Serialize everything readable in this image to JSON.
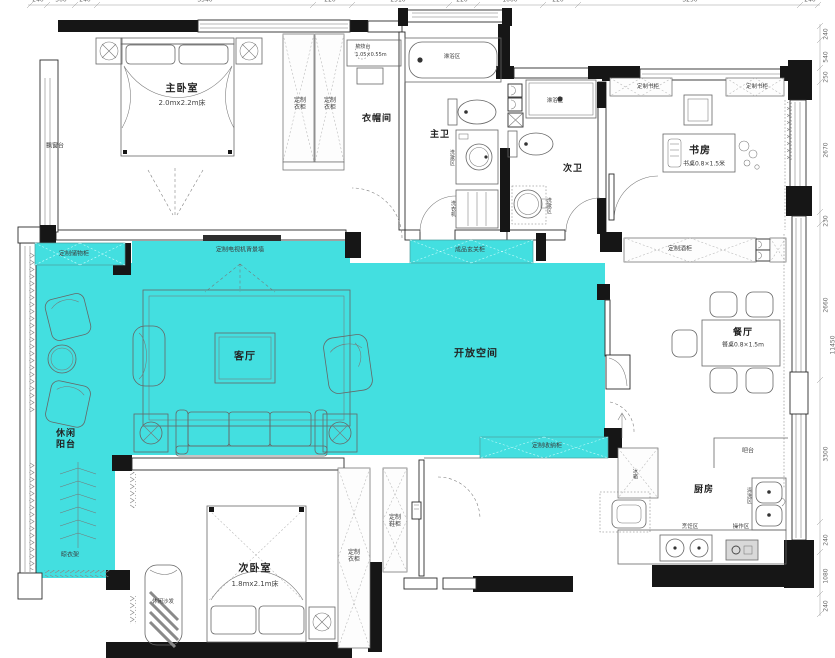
{
  "rooms": {
    "master_bedroom": "主卧室",
    "master_bed_size": "2.0mx2.2m床",
    "cloakroom": "衣帽间",
    "master_bath": "主卫",
    "second_bath": "次卫",
    "study": "书房",
    "study_desk": "书桌0.8×1.5米",
    "living_room": "客厅",
    "open_space": "开放空间",
    "dining_room": "餐厅",
    "dining_table": "餐桌0.8×1.5m",
    "leisure_balcony": "休闲阳台",
    "kitchen": "厨房",
    "second_bedroom": "次卧室",
    "second_bed_size": "1.8mx2.1m床"
  },
  "fixtures": {
    "custom_wardrobe": "定制衣柜",
    "custom_bookcase": "定制书柜",
    "custom_storage": "定制储物柜",
    "tv_wall": "定制电视机背景墙",
    "entry_cabinet": "成品玄关柜",
    "wine_cabinet": "定制酒柜",
    "storage_cabinet": "定制收纳柜",
    "shoe_cabinet": "定制鞋柜",
    "dressing_table": "梳妆台",
    "dressing_table_size": "1.05×0.55m",
    "shower_area": "淋浴区",
    "wash_area": "洗漱区",
    "washer": "洗衣机",
    "bay_window": "飘窗台",
    "drying_rack": "晾衣架",
    "leisure_sofa": "休闲沙发",
    "bar": "吧台",
    "fridge": "冰箱",
    "cleaning_area": "清洗区",
    "cooking_area": "烹饪区",
    "prep_area": "操作区"
  },
  "dimensions": {
    "top": [
      "240",
      "500",
      "240",
      "3540",
      "220",
      "2510",
      "220",
      "1000",
      "220",
      "3290",
      "240"
    ],
    "right": [
      "240",
      "540",
      "250",
      "2670",
      "230",
      "2660",
      "3300",
      "240",
      "1080",
      "240"
    ],
    "overall_right": "11450"
  },
  "colors": {
    "highlight": "#43dfe0",
    "wall": "#161616"
  }
}
